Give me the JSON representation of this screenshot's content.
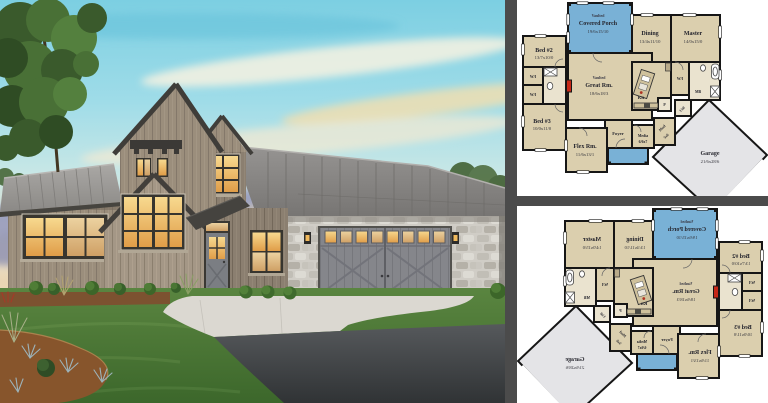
{
  "collage": {
    "divider_color": "#4b4b4b",
    "panel_background": "#ffffff",
    "house_render": {
      "description": "3D dusk rendering of a modern rustic farmhouse with weathered wood siding, standing-seam metal roofs, stone garage wing, glowing windows, lawn, concrete driveway and asphalt road",
      "colors": {
        "sky_top": "#7ccfe2",
        "sky_horizon": "#f2debc",
        "cloud_purple": "#8e92ba",
        "siding": "#9b8e7c",
        "roof": "#8a8885",
        "stone": "#d0cdc6",
        "garage_door": "#85868b",
        "window_glow": "#f0c068",
        "lawn": "#4e7c33",
        "concrete": "#dbd8d1",
        "asphalt": "#45484b",
        "mulch": "#87552c"
      }
    },
    "floor_plan_top": {
      "orientation": "normal"
    },
    "floor_plan_bottom": {
      "orientation": "mirrored",
      "note": "horizontally flipped copy of the top plan with mirrored text"
    }
  },
  "plan_colors": {
    "room_fill": "#dbcfae",
    "bath_fill": "#eae3cf",
    "porch_fill": "#79b1d6",
    "garage_fill": "#e4e4e7",
    "wall": "#161616",
    "fireplace": "#c62817"
  },
  "plan_labels": {
    "porch": {
      "l1": "Vaulted",
      "l2": "Covered Porch",
      "l3": "19/6x15/10"
    },
    "dining": {
      "l1": "Dining",
      "l2": "13/4x11/10"
    },
    "master": {
      "l1": "Master",
      "l2": "14/0x15/0"
    },
    "bed2": {
      "l1": "Bed #2",
      "l2": "13/7x10/0"
    },
    "great": {
      "l1": "Vaulted",
      "l2": "Great Rm.",
      "l3": "18/6x18/3"
    },
    "bed3": {
      "l1": "Bed #3",
      "l2": "10/0x11/0"
    },
    "flex": {
      "l1": "Flex Rm.",
      "l2": "11/6x13/1"
    },
    "media": {
      "l1": "Media",
      "l2": "6/6x7"
    },
    "mud": {
      "l1": "Mud",
      "l2": "5x6"
    },
    "garage": {
      "l1": "Garage",
      "l2": "21/6x28/6"
    },
    "foyer": "Foyer",
    "kit": "Kit",
    "mb": "MB",
    "wi": "W/I",
    "p": "P",
    "util": "Util"
  }
}
